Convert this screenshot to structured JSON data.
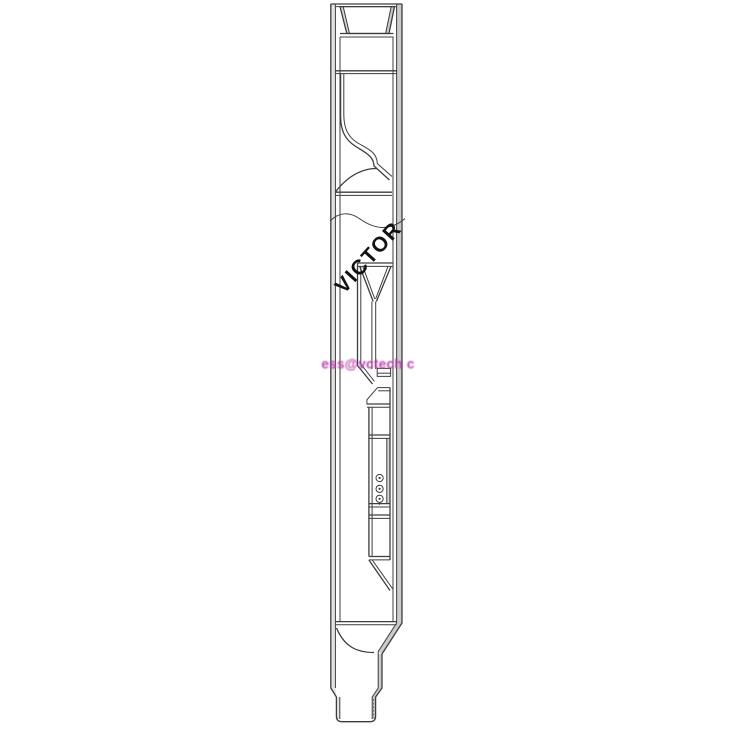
{
  "page": {
    "background": "#ffffff"
  },
  "drawing": {
    "brand_text": "VICTOR",
    "watermark_text": "ess@vctech c",
    "colors": {
      "line": "#3d3d3d",
      "wall_fill": "#e3e3e3",
      "wall_fill_dark": "#cbcbcb",
      "brand_text_color": "#111111",
      "watermark_color": "#b43aa6",
      "background": "#ffffff"
    }
  }
}
